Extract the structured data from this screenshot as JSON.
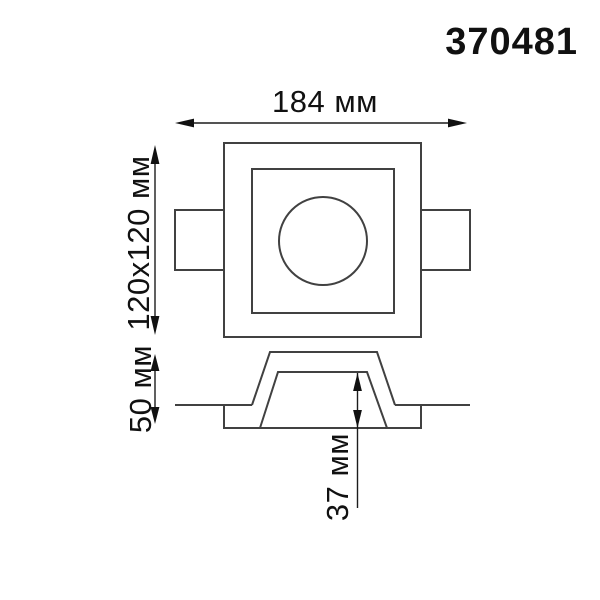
{
  "article_number": "370481",
  "drawing": {
    "type": "technical-dimension-drawing",
    "views": {
      "plan_view": "square recessed downlight face with round lamp opening and two side mounting tabs",
      "section_view": "ceiling recess profile (trapezoid housing below ceiling line)"
    },
    "dimensions": {
      "overall_width": "184 мм",
      "face_size": "120x120 мм",
      "total_depth": "50 мм",
      "recess_depth": "37 мм"
    },
    "colors": {
      "background": "#ffffff",
      "outline": "#414141",
      "dimension_line": "#1c1c1c",
      "text": "#111111"
    }
  }
}
